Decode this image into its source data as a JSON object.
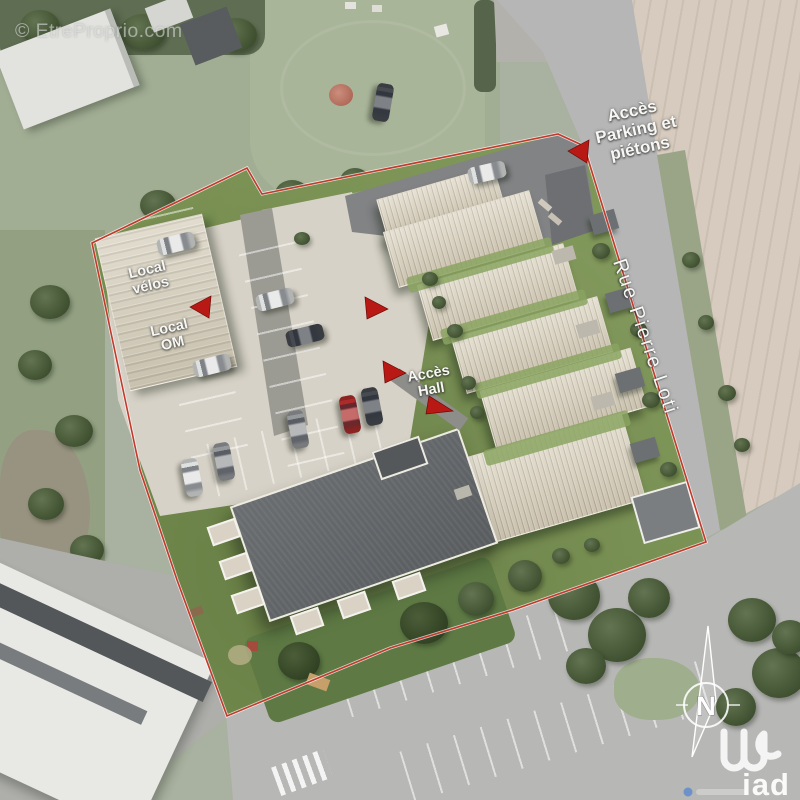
{
  "watermark": "© EtreProprio.com",
  "labels": {
    "access_parking": {
      "line1": "Accès",
      "line2": "Parking et",
      "line3": "piétons"
    },
    "street": "Rue Pierre Loti",
    "local_velos": {
      "line1": "Local",
      "line2": "vélos"
    },
    "local_om": {
      "line1": "Local",
      "line2": "OM"
    },
    "access_hall": {
      "line1": "Accès",
      "line2": "Hall"
    }
  },
  "compass": {
    "north_label": "N"
  },
  "branding": {
    "agency": "iad"
  },
  "colors": {
    "site_boundary_red": "#c9372a",
    "arrow_red": "#bf1712",
    "row_house_roof_beige": "#dcd4bf",
    "collective_building_gray": "#63676a",
    "lawn_green": "#79924f",
    "field_beige": "#d6cbbd",
    "road_gray": "#b6b6b7",
    "parking_paving_light": "#d7d2c6"
  }
}
